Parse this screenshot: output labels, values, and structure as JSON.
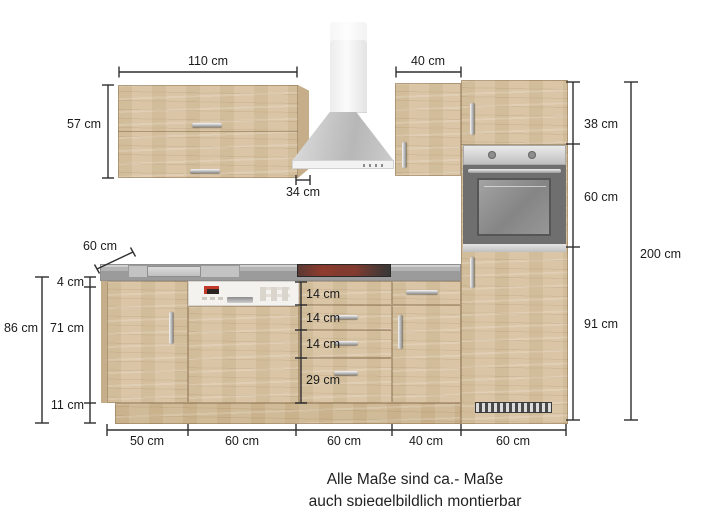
{
  "measurements": {
    "wall_cabinet_width": "110 cm",
    "wall_cabinet_height": "57 cm",
    "upper_cabinet_40_width": "40 cm",
    "wall_cabinet_depth": "34 cm",
    "worktop_depth": "60 cm",
    "tall_cabinet_top_section": "38 cm",
    "tall_cabinet_oven_section": "60 cm",
    "tall_cabinet_bottom_section": "91 cm",
    "total_height": "200 cm",
    "base_total_height": "86 cm",
    "worktop_thickness": "4 cm",
    "base_front_height": "71 cm",
    "plinth_height": "11 cm",
    "drawers": [
      "14 cm",
      "14 cm",
      "14 cm",
      "29 cm"
    ],
    "bottom_widths": [
      "50 cm",
      "60 cm",
      "60 cm",
      "40 cm",
      "60 cm"
    ]
  },
  "footer": {
    "line1": "Alle Maße sind ca.- Maße",
    "line2": "auch spiegelbildlich montierbar"
  },
  "colors": {
    "wood": "#d7c2a1",
    "wood_side": "#bfa783",
    "worktop_gray": "#a3a3a3",
    "stainless": "#c7c7c7",
    "oven_door_gray": "#6f6f6f",
    "cooktop_black": "#3b3836",
    "dimension_line": "#2e2e2e",
    "background": "#ffffff"
  }
}
